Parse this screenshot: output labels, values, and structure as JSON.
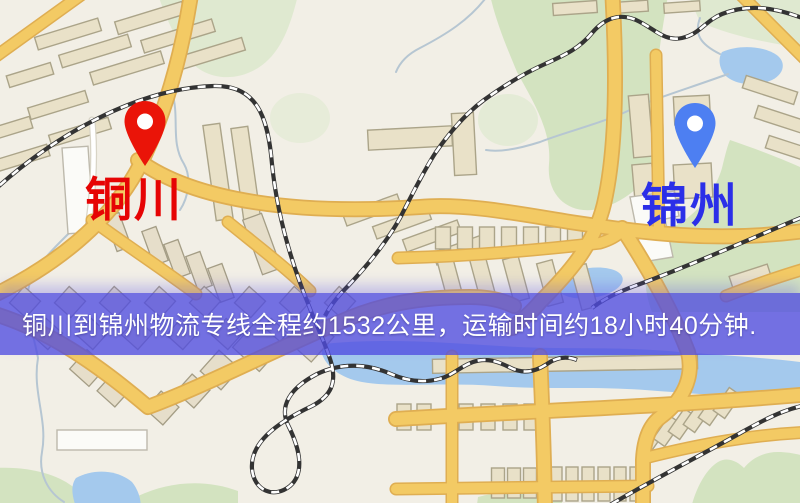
{
  "page": {
    "type": "logistics-route-map-image"
  },
  "banner": {
    "text": "铜川到锦州物流专线全程约1532公里，运输时间约18小时40分钟.",
    "distance_text": "约1532公里",
    "duration_text": "约18小时40分钟",
    "background_color": "#504be1",
    "text_color": "#ffffff"
  },
  "origin": {
    "label": "铜川",
    "pin_color": "#ea1408",
    "label_color": "#e60404"
  },
  "destination": {
    "label": "锦州",
    "pin_color": "#4d7ff2",
    "label_color": "#2b2fe8"
  },
  "map_colors": {
    "background": "#f2efe6",
    "road": "#f3ca64",
    "road_edge": "#dfae52",
    "building": "#e9e1c8",
    "park": "#d3e3c0",
    "water": "#a4c9ed",
    "railway": "#333333"
  }
}
